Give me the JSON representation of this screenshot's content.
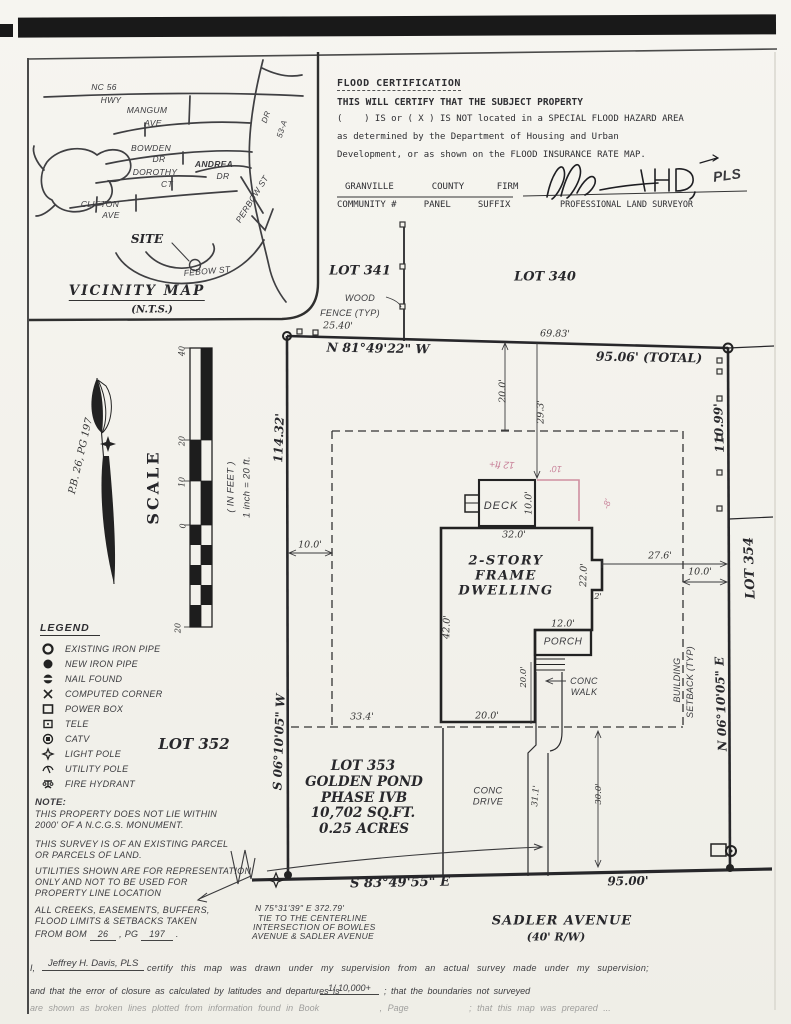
{
  "vicinity": {
    "title": "VICINITY MAP",
    "nts": "(N.T.S.)",
    "site": "SITE",
    "nc56": "NC 56",
    "hwy": "HWY",
    "mangum": "MANGUM",
    "mangum_ave": "AVE",
    "bowden": "BOWDEN",
    "bowden_dr": "DR",
    "andrea": "ANDREA",
    "andrea_dr": "DR",
    "dorothy": "DOROTHY",
    "dorothy_ct": "CT",
    "clifton": "CLIFTON",
    "clifton_ave": "AVE",
    "perbow": "PERBOW ST",
    "febow": "FEBOW ST",
    "diag_dr": "DR",
    "diag_53": "53-A"
  },
  "flood": {
    "title": "FLOOD CERTIFICATION",
    "l1": "THIS WILL CERTIFY THAT THE SUBJECT PROPERTY",
    "l2": "(    ) IS or ( X ) IS NOT located in a SPECIAL FLOOD HAZARD AREA",
    "l3": "as determined by the Department of Housing and Urban",
    "l4": "Development, or as shown on the FLOOD INSURANCE RATE MAP.",
    "row1": "GRANVILLE       COUNTY      FIRM",
    "row2": "COMMUNITY #     PANEL     SUFFIX",
    "sig": "PLS",
    "surveyor": "PROFESSIONAL LAND SURVEYOR"
  },
  "scale": {
    "title": "SCALE",
    "feet": "( IN FEET )",
    "ratio": "1 inch = 20  ft.",
    "t40": "40",
    "t20": "20",
    "t10": "10",
    "t0": "0",
    "t20b": "20",
    "pb": "P.B. 26, PG 197"
  },
  "legend": {
    "title": "LEGEND",
    "items": [
      {
        "icon": "existing-iron-pipe",
        "label": "EXISTING IRON PIPE"
      },
      {
        "icon": "new-iron-pipe",
        "label": "NEW IRON PIPE"
      },
      {
        "icon": "nail-found",
        "label": "NAIL FOUND"
      },
      {
        "icon": "computed-corner",
        "label": "COMPUTED CORNER"
      },
      {
        "icon": "power-box",
        "label": "POWER BOX"
      },
      {
        "icon": "tele",
        "label": "TELE"
      },
      {
        "icon": "catv",
        "label": "CATV"
      },
      {
        "icon": "light-pole",
        "label": "LIGHT POLE"
      },
      {
        "icon": "utility-pole",
        "label": "UTILITY POLE"
      },
      {
        "icon": "fire-hydrant",
        "label": "FIRE HYDRANT"
      }
    ]
  },
  "notes": {
    "heading": "NOTE:",
    "n1a": "THIS PROPERTY DOES NOT LIE WITHIN",
    "n1b": "2000' OF A N.C.G.S. MONUMENT.",
    "n2a": "THIS SURVEY IS OF AN EXISTING PARCEL",
    "n2b": "OR PARCELS OF LAND.",
    "n3a": "UTILITIES SHOWN ARE FOR REPRESENTATION",
    "n3b": "ONLY AND NOT TO BE USED FOR",
    "n3c": "PROPERTY LINE LOCATION",
    "n4a": "ALL CREEKS, EASEMENTS, BUFFERS,",
    "n4b": "FLOOD LIMITS & SETBACKS TAKEN",
    "n4c": "FROM BOM",
    "bom": "26",
    "pg_label": ", PG",
    "pg": "197",
    "end": "."
  },
  "plat": {
    "lot341": "LOT 341",
    "lot340": "LOT 340",
    "lot352": "LOT 352",
    "lot354": "LOT 354",
    "parcel": [
      "LOT 353",
      "GOLDEN POND",
      "PHASE IVB",
      "10,702 SQ.FT.",
      "0.25 ACRES"
    ],
    "wood": "WOOD",
    "fence": "FENCE (TYP)",
    "brg_n": "N 81°49'22\" W",
    "brg_w": "S 06°10'05\" W",
    "brg_e": "N 06°10'05\" E",
    "brg_s": "S 83°49'55\" E",
    "d2540": "25.40'",
    "d6983": "69.83'",
    "d9506": "95.06' (TOTAL)",
    "d11432": "114.32'",
    "d11099": "110.99'",
    "d9500": "95.00'",
    "setback1": "BUILDING",
    "setback2": "SETBACK (TYP)",
    "dwelling": [
      "2-STORY",
      "FRAME",
      "DWELLING"
    ],
    "deck": "DECK",
    "porch": "PORCH",
    "walk1": "CONC",
    "walk2": "WALK",
    "drive1": "CONC",
    "drive2": "DRIVE",
    "dims": {
      "d20top": "20.0'",
      "d293": "29.3'",
      "d10deck": "10.0'",
      "d320": "32.0'",
      "d420": "42.0'",
      "d220": "22.0'",
      "d2": "2'",
      "d120": "12.0'",
      "d20walk": "20.0'",
      "d20house": "20.0'",
      "d10left": "10.0'",
      "d10right": "10.0'",
      "d334": "33.4'",
      "d276": "27.6'",
      "d311": "31.1'",
      "d300": "30.0'"
    },
    "red": {
      "r1": "12 ft+",
      "r2": "10'",
      "r3": "-8'"
    },
    "street": "SADLER AVENUE",
    "street_rw": "(40' R/W)",
    "tie": [
      "N 75°31'39\" E    372.79'",
      "TIE TO THE CENTERLINE",
      "INTERSECTION OF BOWLES",
      "AVENUE & SADLER AVENUE"
    ]
  },
  "cert": {
    "pre": "I,",
    "name": "Jeffrey H. Davis, PLS",
    "l1": "certify this map was drawn under my  supervision from an actual survey made under my supervision;",
    "l2a": "and that the error of closure as calculated by latitudes and departures is",
    "ratio": "1/ 10,000+",
    "l2b": "; that the boundaries not surveyed",
    "l3": "are shown as broken lines plotted from information found in Book           , Page           ; that this map was prepared ..."
  }
}
